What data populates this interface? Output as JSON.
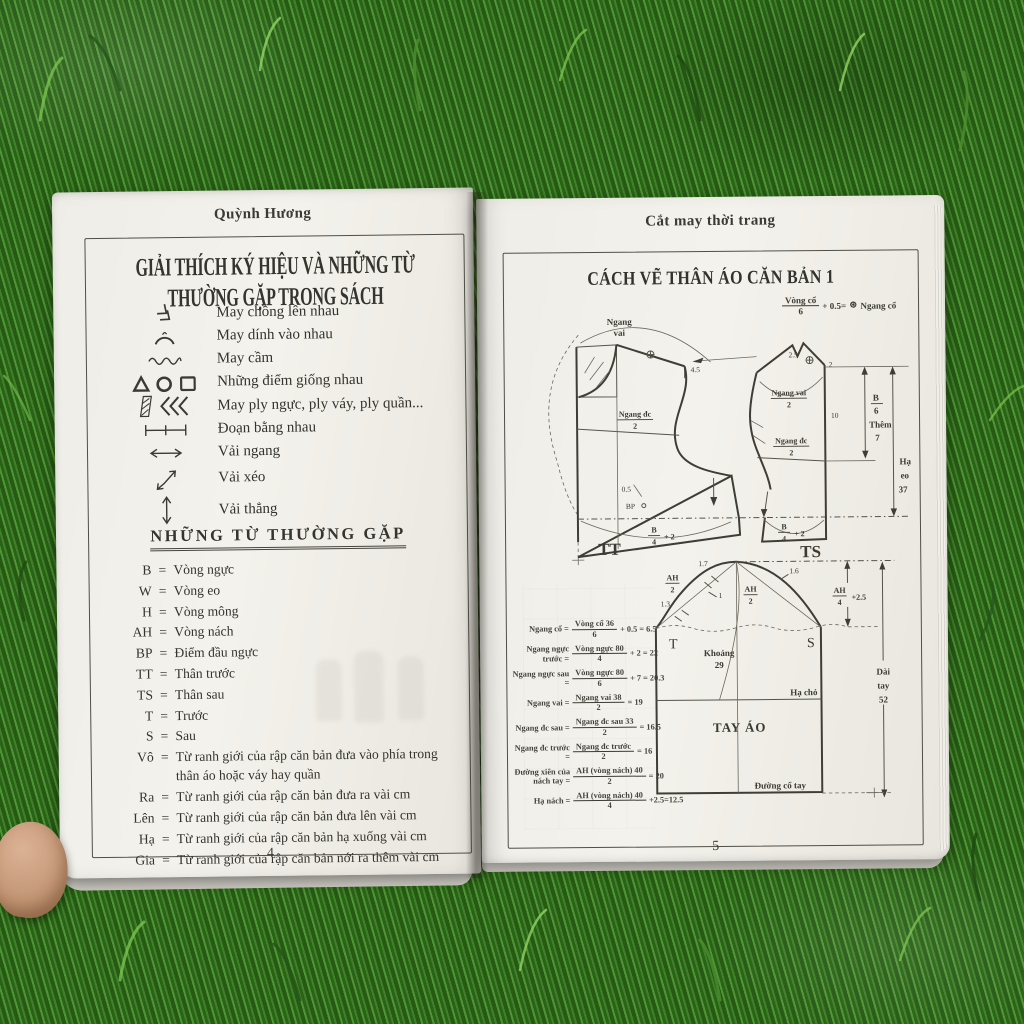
{
  "scene": {
    "description": "open tailoring book lying on grass, thumb holding lower left",
    "grass_color": "#35701f",
    "page_color": "#f2f0ea",
    "ink_color": "#3b3a33"
  },
  "left_page": {
    "running_head": "Quỳnh Hương",
    "title": "GIẢI THÍCH KÝ HIỆU VÀ NHỮNG TỪ THƯỜNG GẶP TRONG SÁCH",
    "equals": "=",
    "symbols": [
      {
        "icon": "overlap-chevrons",
        "label": "May chồng lên nhau"
      },
      {
        "icon": "attach-arc",
        "label": "May dính vào nhau"
      },
      {
        "icon": "gather-wave",
        "label": "May cầm"
      },
      {
        "icon": "triangle-circle-square",
        "label": "Những điểm giống nhau"
      },
      {
        "icon": "pleat-hatch",
        "label": "May ply ngực, ply váy, ply quần..."
      },
      {
        "icon": "equal-segments",
        "label": "Đoạn bằng nhau"
      },
      {
        "icon": "horizontal-arrow",
        "label": "Vải ngang"
      },
      {
        "icon": "diagonal-arrow",
        "label": "Vải xéo"
      },
      {
        "icon": "vertical-arrow",
        "label": "Vải thẳng"
      }
    ],
    "section_heading": "NHỮNG TỪ THƯỜNG GẶP",
    "terms": [
      {
        "abbr": "B",
        "meaning": "Vòng ngực"
      },
      {
        "abbr": "W",
        "meaning": "Vòng eo"
      },
      {
        "abbr": "H",
        "meaning": "Vòng mông"
      },
      {
        "abbr": "AH",
        "meaning": "Vòng nách"
      },
      {
        "abbr": "BP",
        "meaning": "Điểm đầu ngực"
      },
      {
        "abbr": "TT",
        "meaning": "Thân trước"
      },
      {
        "abbr": "TS",
        "meaning": "Thân sau"
      },
      {
        "abbr": "T",
        "meaning": "Trước"
      },
      {
        "abbr": "S",
        "meaning": "Sau"
      },
      {
        "abbr": "Vô",
        "meaning": "Từ ranh giới của rập căn bản đưa vào phía trong thân áo hoặc váy hay quần"
      },
      {
        "abbr": "Ra",
        "meaning": "Từ ranh giới của rập căn bản đưa ra vài cm"
      },
      {
        "abbr": "Lên",
        "meaning": "Từ ranh giới của rập căn bản đưa lên vài cm"
      },
      {
        "abbr": "Hạ",
        "meaning": "Từ ranh giới của rập căn bản hạ xuống vài cm"
      },
      {
        "abbr": "Gia",
        "meaning": "Từ ranh giới của rập căn bản nới ra thêm vài cm"
      }
    ],
    "page_number": "4"
  },
  "right_page": {
    "running_head": "Cắt may thời trang",
    "title": "CÁCH VẼ THÂN ÁO CĂN BẢN 1",
    "neck_formula": {
      "num": "Vòng cổ",
      "den": "6",
      "mid": "+ 0.5=",
      "sym": "⊛",
      "label": "Ngang cổ"
    },
    "bodice": {
      "arc_label_1": "Ngang",
      "arc_label_2": "vai",
      "v45": "4.5",
      "v05": "0.5",
      "bp": "BP",
      "tt": "TT",
      "ts": "TS",
      "v25": "2.5",
      "v2": "2",
      "v10": "10",
      "ngang_dc": "Ngang đc",
      "ngang_vai": "Ngang vai",
      "den2": "2",
      "b": "B",
      "den4": "4",
      "plus2": "+ 2",
      "den6": "6",
      "them": "Thêm",
      "v7": "7",
      "ha": "Hạ",
      "eo": "eo",
      "v37": "37"
    },
    "sleeve": {
      "v17": "1.7",
      "v1": "1",
      "v13": "1.3",
      "v16": "1.6",
      "ah": "AH",
      "den2": "2",
      "den4": "4",
      "plus25": "+2.5",
      "t": "T",
      "s": "S",
      "khoang": "Khoảng",
      "v29": "29",
      "ha_cho": "Hạ chỏ",
      "tay_ao": "TAY ÁO",
      "dai": "Dài",
      "tay": "tay",
      "v52": "52",
      "duong_co_tay": "Đường cổ tay"
    },
    "formulas": [
      {
        "label": "Ngang cổ =",
        "num": "Vòng cổ 36",
        "den": "6",
        "tail": "+ 0.5 = 6.5"
      },
      {
        "label": "Ngang ngực trước =",
        "num": "Vòng ngực 80",
        "den": "4",
        "tail": "+ 2 = 22"
      },
      {
        "label": "Ngang ngực sau =",
        "num": "Vòng ngực 80",
        "den": "6",
        "tail": "+ 7 = 20.3"
      },
      {
        "label": "Ngang vai =",
        "num": "Ngang vai 38",
        "den": "2",
        "tail": "= 19"
      },
      {
        "label": "Ngang đc sau =",
        "num": "Ngang đc sau 33",
        "den": "2",
        "tail": "= 16.5"
      },
      {
        "label": "Ngang đc trước =",
        "num": "Ngang đc trước",
        "den": "2",
        "tail": "= 16"
      },
      {
        "label": "Đường xiên của nách tay =",
        "num": "AH (vòng nách) 40",
        "den": "2",
        "tail": "= 20"
      },
      {
        "label": "Hạ nách =",
        "num": "AH (vòng nách) 40",
        "den": "4",
        "tail": "+2.5=12.5"
      }
    ],
    "page_number": "5"
  }
}
